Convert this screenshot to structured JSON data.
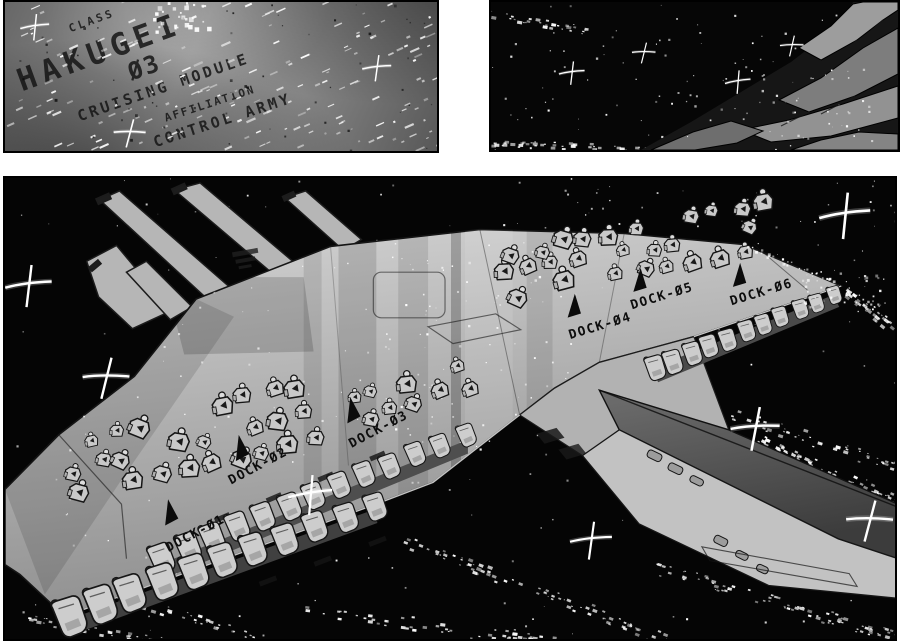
{
  "panel_intro": {
    "class_label": "CLASS",
    "ship_name": "HAKUGEI",
    "ship_number": "Ø3",
    "module_type": "CRUISING MODULE",
    "affiliation_label": "AFFILIATION",
    "affiliation_value": "CONTROL ARMY"
  },
  "ship": {
    "docks": [
      {
        "label": "DOCK-Ø1"
      },
      {
        "label": "DOCK-Ø2"
      },
      {
        "label": "DOCK-Ø3"
      },
      {
        "label": "DOCK-Ø4"
      },
      {
        "label": "DOCK-Ø5"
      },
      {
        "label": "DOCK-Ø6"
      }
    ]
  },
  "colors": {
    "page_bg": "#ffffff",
    "space_black": "#050505",
    "panel_gray": "#8b8b8b",
    "hull_light": "#c6c6c6",
    "hull_mid": "#a8a8a8",
    "hull_dark": "#474747",
    "ink": "#111111",
    "star_white": "#ffffff"
  }
}
